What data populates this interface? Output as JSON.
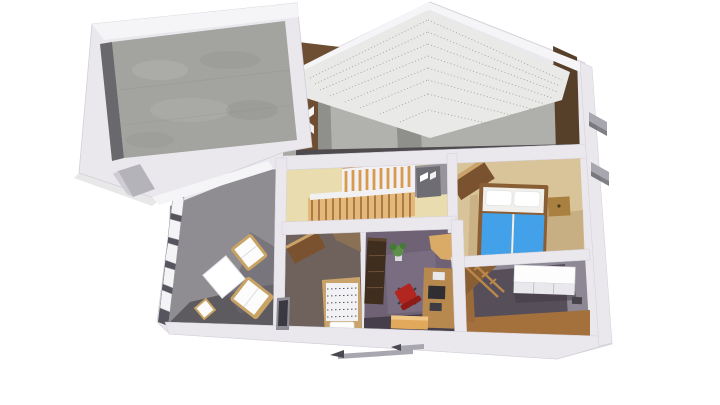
{
  "scene": {
    "description": "Aerial 3D cutaway rendering of a house floor plan: attached garage with concrete floor, gabled attic cross-section with dotted roof underside and wood gable walls, and a furnished ground floor with living room, stair hall, bedroom, small bedroom, office and storage room",
    "view": "aerial three-quarter cutaway (dollhouse) view",
    "background": "white",
    "rooms": [
      {
        "name": "garage",
        "floor": "concrete",
        "features": [
          "white walls",
          "open top",
          "side door"
        ]
      },
      {
        "name": "attic-cutaway",
        "features": [
          "dotted roof underside",
          "brown wood gable walls",
          "concrete core walls",
          "dark attic floor"
        ]
      },
      {
        "name": "living-room",
        "floor": "gray",
        "furniture": [
          "window-band",
          "sofa",
          "sofa",
          "coffee-table",
          "stool"
        ]
      },
      {
        "name": "stair-hall",
        "floor": "light wood",
        "furniture": [
          "staircase",
          "baluster-railing",
          "gray-door"
        ]
      },
      {
        "name": "bedroom",
        "floor": "tan wood",
        "furniture": [
          "double-bed-blue",
          "pillows",
          "nightstand",
          "wardrobe"
        ]
      },
      {
        "name": "small-bedroom",
        "floor": "dark",
        "furniture": [
          "patterned-bed",
          "pillow",
          "wardrobe",
          "wall-opening"
        ]
      },
      {
        "name": "office",
        "floor": "purple carpet",
        "furniture": [
          "bookcase",
          "red-office-chair",
          "desk-with-monitor",
          "corner-desk",
          "plant",
          "sideboard"
        ]
      },
      {
        "name": "storage-room",
        "floor": "dark purple with wood border",
        "furniture": [
          "white-cabinet",
          "ladder"
        ]
      }
    ],
    "exterior": [
      "two awnings on right wall",
      "two awnings below front wall"
    ]
  },
  "colors": {
    "background": "#ffffff",
    "wallWhite": "#eae8ed",
    "wallBright": "#f5f4f7",
    "wallShade": "#cfccd4",
    "wallEdge": "#d2cfd8",
    "garageFloor": "#a3a3a0",
    "garageFloorLight": "#b9b9b6",
    "garageFloorDark": "#8b8b89",
    "garageInnerDark": "#69686c",
    "garageShadow": "#d9d9db",
    "doorSlabGray": "#b5b3ba",
    "atticWall": "#8f8f8b",
    "atticWallLight": "#b5b5b1",
    "atticFloor": "#4e4a4e",
    "gableBrown": "#6e4e33",
    "gableBrownDark": "#57402a",
    "roofUnder": "#e9e9e7",
    "roofDot": "#90908e",
    "leftStripGray": "#a8a8a5",
    "floorGray": "#8f8d92",
    "floorGrayDark": "#5d5a60",
    "shadowGray": "#6b6870",
    "windowBandDark": "#56545c",
    "glassWhite": "#f4f4f6",
    "paneFrame": "#9a98a0",
    "sofaWood": "#c9a364",
    "cushionWhite": "#fcfcfc",
    "tableWhite": "#ffffff",
    "tableEdge": "#e3e3e7",
    "hallWood": "#e9dcae",
    "stairTread": "#e3b878",
    "stairTreadLine": "#8a5a2e",
    "stairRail": "#d79a4e",
    "handrail": "#c08a4a",
    "stairWhite": "#f1f0f3",
    "doorGray": "#6f6d74",
    "landingGray": "#97949c",
    "bedroomFloor": "#d9c499",
    "bedroomShade": "#c3aa7d",
    "wardrobeBrown": "#7a5230",
    "wardrobeTop": "#caa36a",
    "bedFrame": "#8a5e35",
    "bedHead": "#f2f0ed",
    "pillowWhite": "#ffffff",
    "pillowEdge": "#e2e2e2",
    "bedBlue": "#42a1e9",
    "nightstandWood": "#a9803f",
    "knobDark": "#4a3a20",
    "smallFloor": "#6f625c",
    "smallFloorLight": "#8d7355",
    "duvetWhite": "#f2f1f4",
    "duvetDot": "#53525e",
    "footWhite": "#ececec",
    "officeCarpet": "#6e6274",
    "officeCarpetLight": "#7d7186",
    "officeDark": "#403a44",
    "cabinetDark": "#3f2d1d",
    "cabinetLine": "#6a5138",
    "cabinetTop": "#5a4430",
    "chairRed": "#b3261f",
    "chairRedDark": "#8e1b16",
    "chairBase": "#3a3a3e",
    "deskWood": "#b8894e",
    "deskLight": "#d9ab66",
    "monitorDark": "#2e2e33",
    "printerDark": "#3c3c42",
    "paperWhite": "#e9e9ec",
    "plantGreen": "#5d8f4a",
    "plantGreenDark": "#477a36",
    "potWhite": "#d9d9de",
    "benchTan": "#e2a95c",
    "benchTop": "#f0c685",
    "brFloorLight": "#8d8894",
    "brFloorDark": "#564e59",
    "brWood": "#a4713c",
    "brWoodSide": "#9a6a3a",
    "brCorner": "#8a5e33",
    "ladderWood": "#b9874a",
    "cabWhiteTop": "#fdfdfd",
    "cabWhiteFront": "#e9e9ed",
    "cabDivider": "#b8b8c0",
    "cabEdge": "#cbcbd2",
    "ventDark": "#46444a",
    "awningGray": "#a8a6ae",
    "awningDark": "#4a4850",
    "openingDark": "#3a3840",
    "openingFrame": "#8e8c94"
  }
}
